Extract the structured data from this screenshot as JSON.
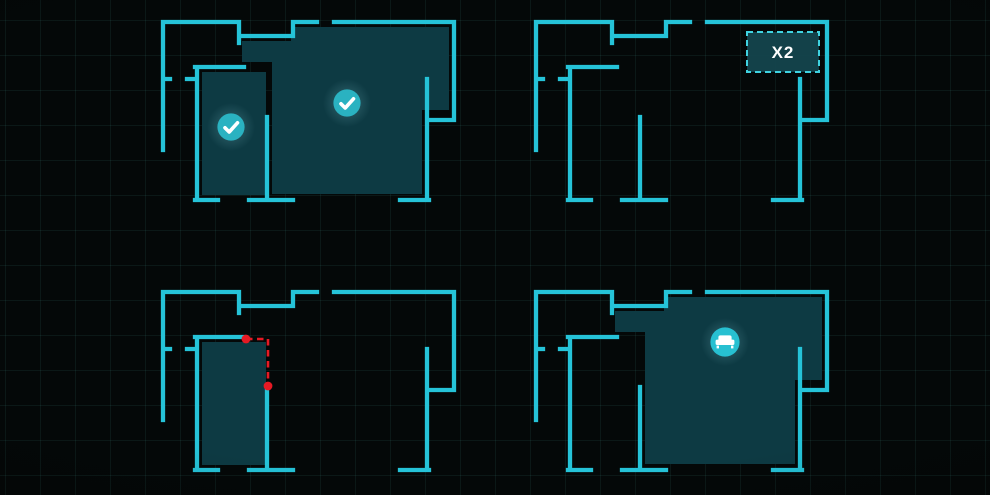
{
  "scene": {
    "width": 990,
    "height": 495,
    "bg_color": "#040808",
    "grid": {
      "size": 35,
      "color": "rgba(80,190,178,0.09)",
      "offset_x": 5,
      "offset_y": 20
    },
    "wall_color": "#25c3d8",
    "wall_thickness": 4.3,
    "room_fill_color": "#0d3a43"
  },
  "floorplan": {
    "width": 291,
    "height": 178,
    "walls": [
      [
        0,
        0,
        76,
        0
      ],
      [
        76,
        0,
        76,
        21
      ],
      [
        76,
        14,
        130,
        14
      ],
      [
        130,
        14,
        130,
        0
      ],
      [
        130,
        0,
        154,
        0
      ],
      [
        171,
        0,
        291,
        0
      ],
      [
        291,
        0,
        291,
        98
      ],
      [
        291,
        98,
        264,
        98
      ],
      [
        264,
        57,
        264,
        178
      ],
      [
        0,
        0,
        0,
        128
      ],
      [
        0,
        57,
        7,
        57
      ],
      [
        24,
        57,
        34,
        57
      ],
      [
        34,
        45,
        34,
        178
      ],
      [
        32,
        45,
        81,
        45
      ],
      [
        104,
        95,
        104,
        178
      ],
      [
        32,
        178,
        55,
        178
      ],
      [
        86,
        178,
        130,
        178
      ],
      [
        237,
        178,
        266,
        178
      ]
    ],
    "rooms": {
      "middle": [
        [
          39,
          50
        ],
        [
          103,
          50
        ],
        [
          103,
          173
        ],
        [
          39,
          173
        ]
      ],
      "big": [
        [
          79,
          19
        ],
        [
          128,
          19
        ],
        [
          128,
          5
        ],
        [
          286,
          5
        ],
        [
          286,
          88
        ],
        [
          259,
          88
        ],
        [
          259,
          172
        ],
        [
          109,
          172
        ],
        [
          109,
          40
        ],
        [
          79,
          40
        ]
      ]
    }
  },
  "markers_style": {
    "check_circle_color": "#2ab2c1",
    "sofa_circle_color": "#27c0d1",
    "glyph_color": "#ffffff",
    "circle_radius": 13.6,
    "sofa_circle_radius": 14.6,
    "halo_radius": 24
  },
  "badge_style": {
    "fill": "rgba(21,70,79,0.92)",
    "border_color": "#3fd3e1",
    "text_color": "#ffffff",
    "font_size": 17
  },
  "edit_style": {
    "color": "#e51a24",
    "dash": "6.5 4.5",
    "line_width": 2.6,
    "handle_radius": 4.4
  },
  "panels": [
    {
      "id": "rooms-selected",
      "x": 163,
      "y": 22,
      "filled_rooms": [
        "middle",
        "big"
      ],
      "markers": [
        {
          "icon": "check",
          "x": 68,
          "y": 105
        },
        {
          "icon": "check",
          "x": 184,
          "y": 81
        }
      ]
    },
    {
      "id": "zone-multiplier",
      "x": 536,
      "y": 22,
      "filled_rooms": [],
      "badge": {
        "label": "X2",
        "x": 211,
        "y": 10,
        "width": 72,
        "height": 40
      }
    },
    {
      "id": "wall-edit",
      "x": 163,
      "y": 292,
      "filled_rooms": [
        "middle"
      ],
      "edit_path": {
        "points": [
          [
            83,
            47
          ],
          [
            105,
            47
          ],
          [
            105,
            94
          ]
        ]
      }
    },
    {
      "id": "furniture-placement",
      "x": 536,
      "y": 292,
      "filled_rooms": [
        "big"
      ],
      "markers": [
        {
          "icon": "sofa",
          "x": 189,
          "y": 50
        }
      ]
    }
  ]
}
